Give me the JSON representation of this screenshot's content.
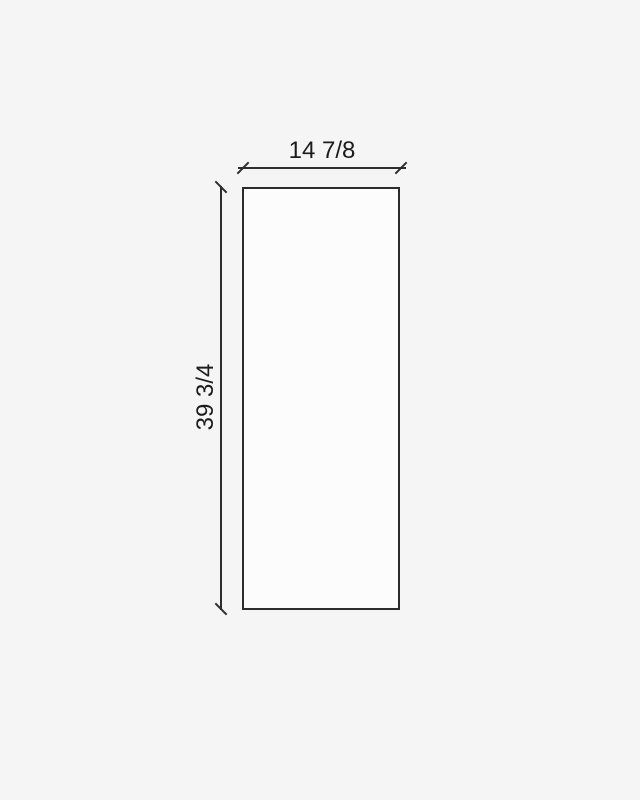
{
  "diagram": {
    "type": "dimensioned-rectangle",
    "width_dimension_label": "14 7/8",
    "height_dimension_label": "39 3/4"
  },
  "colors": {
    "background": "#f5f5f5",
    "panel_fill": "#fcfcfc",
    "line": "#2d2d2d",
    "text": "#1c1c1c"
  }
}
